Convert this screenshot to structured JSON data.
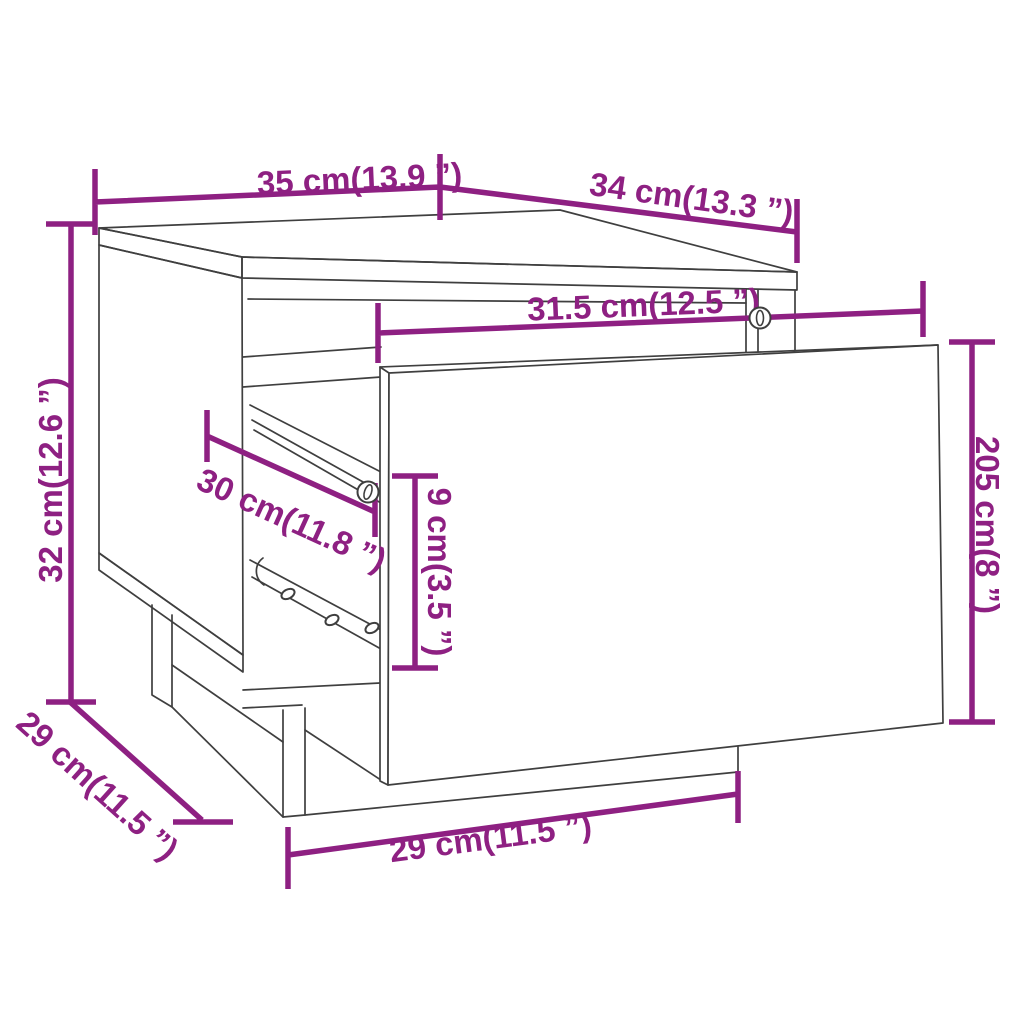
{
  "figure": {
    "type": "product-dimension-diagram",
    "subject": "nightstand with open pulled-out drawer",
    "accent_color": "#8E2082",
    "line_color": "#3f3f3f",
    "background": "#ffffff"
  },
  "dimensions": {
    "top_width": {
      "label": "35 cm(13.9 ”)",
      "cm": 35,
      "inches": 13.9
    },
    "top_depth": {
      "label": "34 cm(13.3 ”)",
      "cm": 34,
      "inches": 13.3
    },
    "side_height": {
      "label": "32 cm(12.6 ”)",
      "cm": 32,
      "inches": 12.6
    },
    "opening_width": {
      "label": "31.5 cm(12.5 ”)",
      "cm": 31.5,
      "inches": 12.5
    },
    "drawer_depth": {
      "label": "30 cm(11.8 ”)",
      "cm": 30,
      "inches": 11.8
    },
    "drawer_gap_height": {
      "label": "9 cm(3.5 ”)",
      "cm": 9,
      "inches": 3.5
    },
    "drawer_front_height": {
      "label": "205 cm(8 ”)",
      "cm": 205,
      "inches": 8
    },
    "base_depth": {
      "label": "29 cm(11.5 ”)",
      "cm": 29,
      "inches": 11.5
    },
    "base_width": {
      "label": "29 cm(11.5 ”)",
      "cm": 29,
      "inches": 11.5
    }
  }
}
